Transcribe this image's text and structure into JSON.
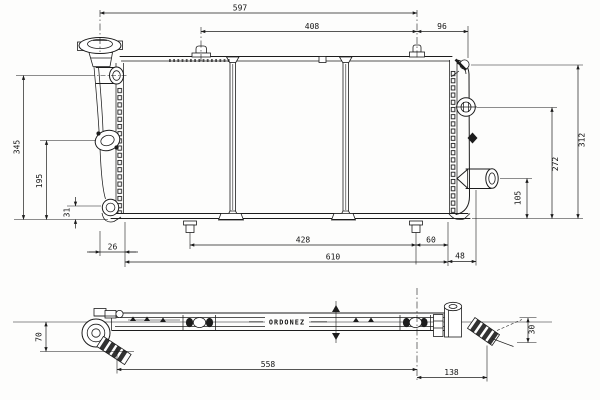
{
  "branding": {
    "text": "ORDONEZ"
  },
  "dimensions_front": {
    "top_width": "597",
    "top_inner_width": "408",
    "top_right_offset": "96",
    "left_overall_height": "345",
    "left_inlet_height": "195",
    "left_outlet_offset": "31",
    "bottom_left_offset": "26",
    "bottom_inner_width": "428",
    "bottom_stud_offset": "60",
    "bottom_core_width": "610",
    "bottom_right_offset": "48",
    "right_overall_height": "312",
    "right_bolt_height": "272",
    "right_outlet_height": "105"
  },
  "dimensions_bottom": {
    "depth_left": "70",
    "overall_length": "558",
    "right_section": "138",
    "depth_right": "30"
  },
  "colors": {
    "ink": "#1c1c1c",
    "paper": "#fdfdfc"
  }
}
